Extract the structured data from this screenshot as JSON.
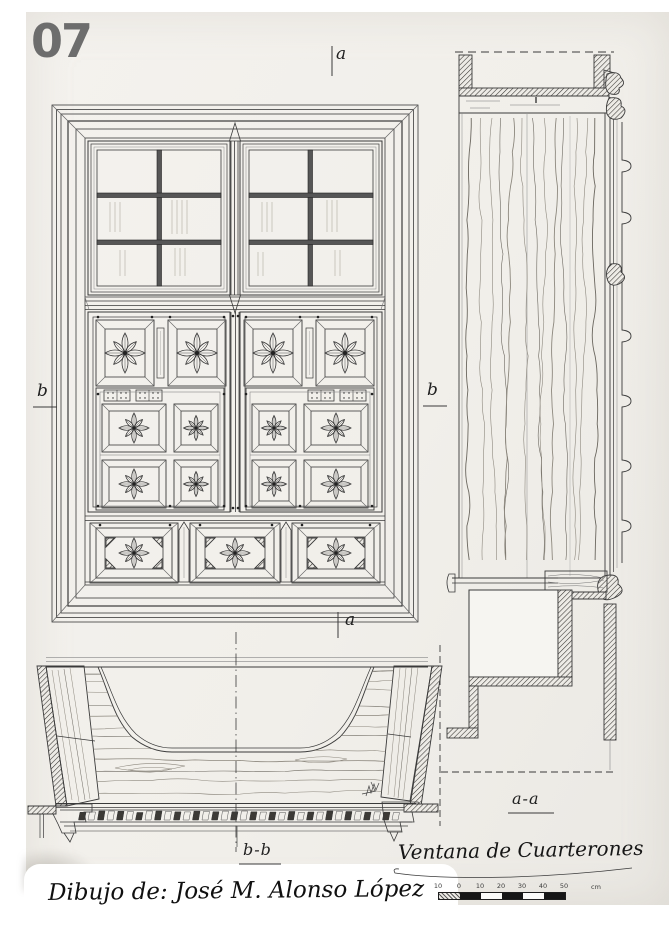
{
  "page_number": "07",
  "marks": {
    "a_top": "a",
    "a_bottom": "a",
    "b_left": "b",
    "b_right": "b",
    "aa": "a-a",
    "bb": "b-b"
  },
  "title": "Ventana de Cuarterones",
  "credit": "Dibujo de: José M. Alonso López",
  "scale_bar": {
    "tick_labels": [
      "10",
      "0",
      "10",
      "20",
      "30",
      "40",
      "50"
    ],
    "unit": "cm"
  },
  "colors": {
    "ink": "#3a3a3a",
    "paper": "#f1efea",
    "page_number_gray": "#6d6d6d"
  }
}
